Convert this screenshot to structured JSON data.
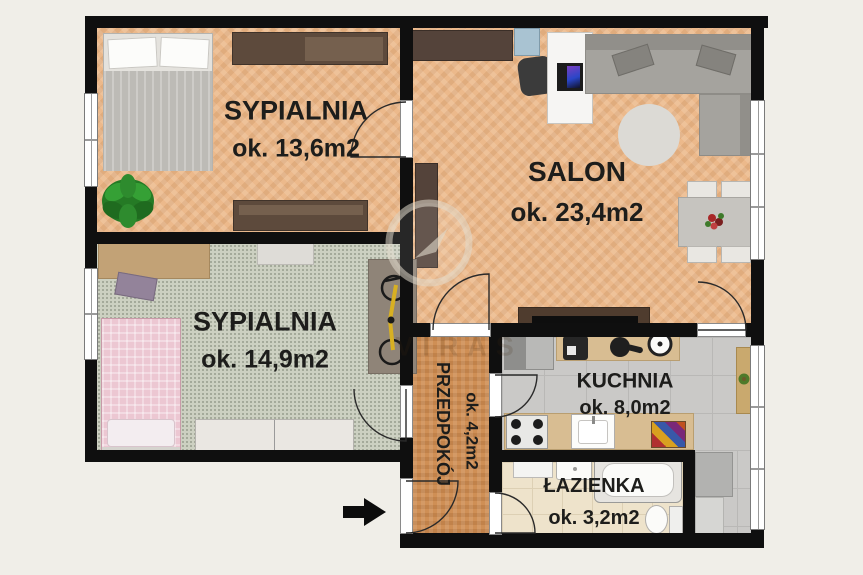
{
  "watermark": {
    "text": "VIRAS"
  },
  "rooms": [
    {
      "id": "sypialnia-1",
      "name": "SYPIALNIA",
      "area": "ok. 13,6m2"
    },
    {
      "id": "salon",
      "name": "SALON",
      "area": "ok. 23,4m2"
    },
    {
      "id": "sypialnia-2",
      "name": "SYPIALNIA",
      "area": "ok. 14,9m2"
    },
    {
      "id": "przedpokoj",
      "name": "PRZEDPOKÓJ",
      "area": "ok. 4,2m2"
    },
    {
      "id": "kuchnia",
      "name": "KUCHNIA",
      "area": "ok. 8,0m2"
    },
    {
      "id": "lazienka",
      "name": "ŁAZIENKA",
      "area": "ok. 3,2m2"
    }
  ],
  "colors": {
    "wall": "#0f0f0f",
    "background": "#f0eee8",
    "wood": "#ecb98b",
    "hall_wood": "#cf8f55",
    "carpet": "#ccd0c1",
    "kitchen_tile": "#cac9c7",
    "bath_tile": "#eee3cb",
    "accent_plant": "#2e8b2e",
    "bike_frame": "#d8b022"
  }
}
